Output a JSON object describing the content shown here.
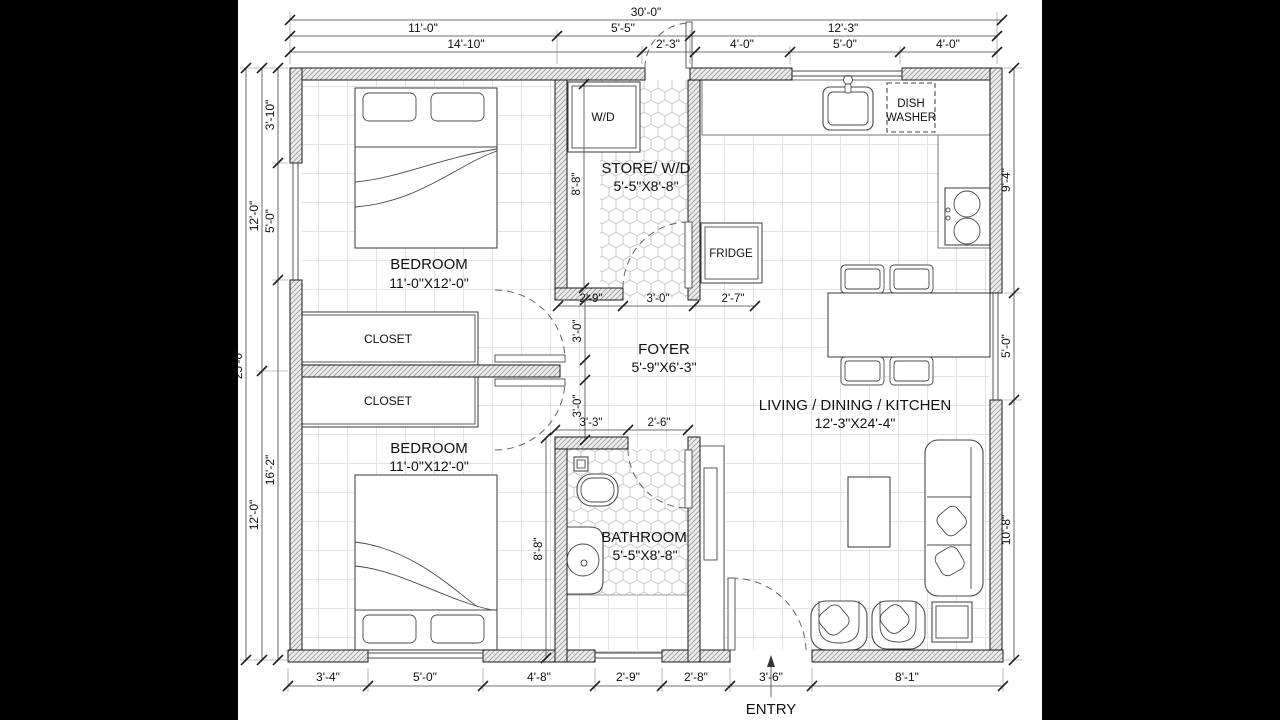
{
  "rooms": {
    "bedroom_top": {
      "name": "BEDROOM",
      "size": "11'-0\"X12'-0\""
    },
    "bedroom_bottom": {
      "name": "BEDROOM",
      "size": "11'-0\"X12'-0\""
    },
    "closet_top": {
      "name": "CLOSET"
    },
    "closet_bottom": {
      "name": "CLOSET"
    },
    "store": {
      "name": "STORE/ W/D",
      "size": "5'-5\"X8'-8\""
    },
    "foyer": {
      "name": "FOYER",
      "size": "5'-9\"X6'-3\""
    },
    "bathroom": {
      "name": "BATHROOM",
      "size": "5'-5\"X8'-8\""
    },
    "living": {
      "name": "LIVING / DINING / KITCHEN",
      "size": "12'-3\"X24'-4\""
    }
  },
  "appliances": {
    "washer_dryer": "W/D",
    "fridge": "FRIDGE",
    "dishwasher_line1": "DISH",
    "dishwasher_line2": "WASHER"
  },
  "entry": {
    "label": "ENTRY"
  },
  "dims": {
    "top_overall": "30'-0\"",
    "top_row2": [
      "11'-0\"",
      "5'-5\"",
      "12'-3\""
    ],
    "top_row3": [
      "14'-10\"",
      "2'-3\"",
      "4'-0\"",
      "5'-0\"",
      "4'-0\""
    ],
    "left_overall": "25'-0\"",
    "left_row2": [
      "12'-0\"",
      "12'-0\""
    ],
    "left_row3": [
      "3'-10\"",
      "5'-0\"",
      "16'-2\""
    ],
    "right_col": [
      "9'-4\"",
      "5'-0\"",
      "10'-8\""
    ],
    "bottom_row": [
      "3'-4\"",
      "5'-0\"",
      "4'-8\"",
      "2'-9\"",
      "2'-8\"",
      "3'-6\"",
      "8'-1\""
    ],
    "store_height": "8'-8\"",
    "store_bottom": [
      "2'-9\"",
      "3'-0\"",
      "2'-7\""
    ],
    "foyer_doors": [
      "3'-0\"",
      "3'-0\""
    ],
    "bath_top": [
      "3'-3\"",
      "2'-6\""
    ],
    "bath_height": "8'-8\""
  }
}
